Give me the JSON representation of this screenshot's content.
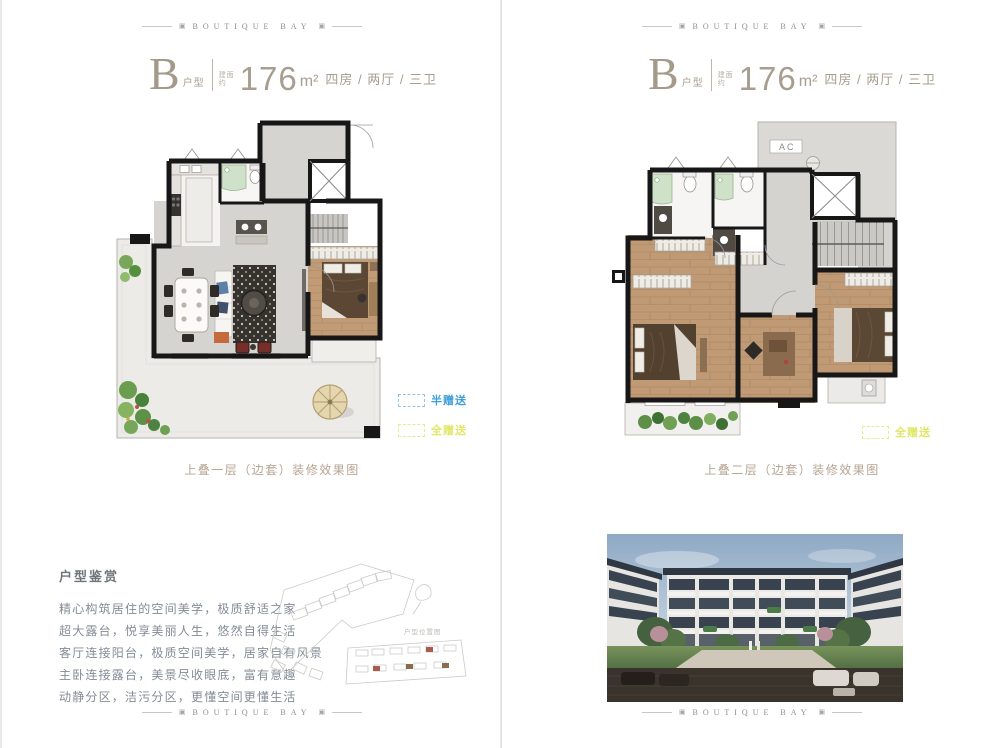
{
  "brand": {
    "name": "BOUTIQUE BAY",
    "ornament": "▣"
  },
  "unit_title": {
    "letter": "B",
    "letter_suffix": "户型",
    "area_label_line1": "建面",
    "area_label_line2": "约",
    "area_number": "176",
    "area_unit": "m²",
    "rooms": "四房 / 两厅 / 三卫"
  },
  "left_page": {
    "caption": "上叠一层（边套）装修效果图",
    "legend": [
      {
        "label": "半赠送",
        "color": "#3da0da"
      },
      {
        "label": "全赠送",
        "color": "#e4ea67"
      }
    ]
  },
  "right_page": {
    "caption": "上叠二层（边套）装修效果图",
    "legend": [
      {
        "label": "全赠送",
        "color": "#e4ea67"
      }
    ],
    "plan_labels": {
      "ac": "AC"
    }
  },
  "appreciation": {
    "heading": "户型鉴赏",
    "lines": [
      "精心构筑居住的空间美学，极质舒适之家",
      "超大露台，悦享美丽人生，悠然自得生活",
      "客厅连接阳台，极质空间美学，居家自有风景",
      "主卧连接露台，美景尽收眼底，富有意趣",
      "动静分区，洁污分区，更懂空间更懂生活"
    ]
  },
  "site_plan": {
    "label": "户型位置图"
  }
}
